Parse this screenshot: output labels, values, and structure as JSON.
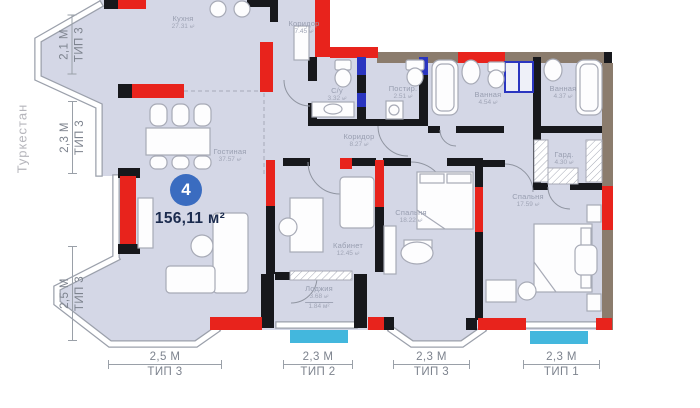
{
  "location": "Туркестан",
  "unit": {
    "number": "4",
    "total_area": "156,11 м²"
  },
  "area_unit": "м²",
  "rooms": [
    {
      "name": "Кухня",
      "area": "27.31"
    },
    {
      "name": "Коридор",
      "area": "7.45"
    },
    {
      "name": "С/у",
      "area": "3.32"
    },
    {
      "name": "Постир.",
      "area": "2.51"
    },
    {
      "name": "Ванная",
      "area": "4.54"
    },
    {
      "name": "Ванная",
      "area": "4.37"
    },
    {
      "name": "Коридор",
      "area": "8.27"
    },
    {
      "name": "Гостиная",
      "area": "37.57"
    },
    {
      "name": "Гард.",
      "area": "4.30"
    },
    {
      "name": "Кабинет",
      "area": "12.45"
    },
    {
      "name": "Спальня",
      "area": "18.22"
    },
    {
      "name": "Спальня",
      "area": "17.59"
    },
    {
      "name": "Лоджия",
      "area": "3.68",
      "area2": "1.84"
    }
  ],
  "dimensions": {
    "left": [
      {
        "length": "2,1 М",
        "type": "ТИП 3"
      },
      {
        "length": "2,3 М",
        "type": "ТИП 3"
      },
      {
        "length": "2,5 М",
        "type": "ТИП 3"
      }
    ],
    "bottom": [
      {
        "length": "2,5 М",
        "type": "ТИП 3"
      },
      {
        "length": "2,3 М",
        "type": "ТИП 2"
      },
      {
        "length": "2,3 М",
        "type": "ТИП 3"
      },
      {
        "length": "2,3 М",
        "type": "ТИП 1"
      }
    ]
  },
  "colors": {
    "floor": "#d4d7e6",
    "wall": "#17181c",
    "highlight_red": "#e8231c",
    "exterior_brown": "#8b7c6d",
    "plumbing_blue": "#2a35c0",
    "window_cyan": "#43b7dd",
    "badge_blue": "#3a6cc0",
    "area_text": "#1b2b4e"
  }
}
